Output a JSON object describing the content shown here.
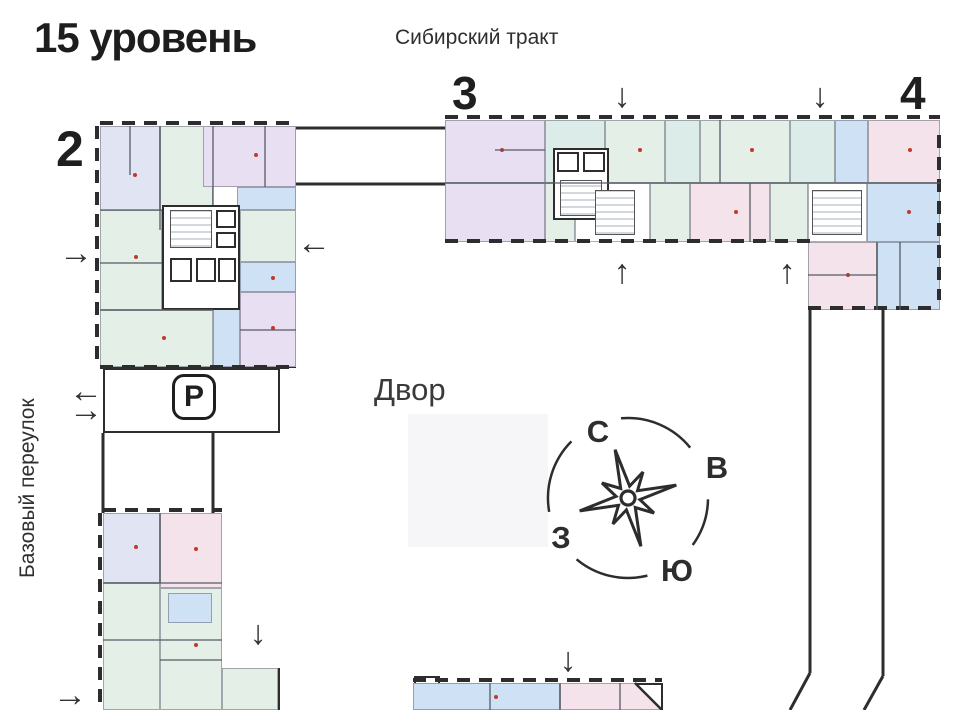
{
  "title": "15 уровень",
  "labels": {
    "street_top": "Сибирский тракт",
    "street_left": "Базовый переулок",
    "courtyard": "Двор",
    "parking": "P"
  },
  "buildings": [
    {
      "number": "2",
      "x": 56,
      "y": 124,
      "size": 50
    },
    {
      "number": "3",
      "x": 452,
      "y": 70,
      "size": 46
    },
    {
      "number": "4",
      "x": 900,
      "y": 70,
      "size": 46
    }
  ],
  "compass": {
    "north": "С",
    "east": "В",
    "south": "Ю",
    "west": "З",
    "letters": [
      {
        "key": "north",
        "x": 598,
        "y": 432
      },
      {
        "key": "east",
        "x": 717,
        "y": 468
      },
      {
        "key": "west",
        "x": 561,
        "y": 538
      },
      {
        "key": "south",
        "x": 677,
        "y": 571
      }
    ]
  },
  "colors": {
    "wall": "#2d2d2d",
    "lavender": "#e0e4f3",
    "green": "#e3efe7",
    "teal": "#dcece8",
    "purple": "#e9dff2",
    "pink": "#f5e3ec",
    "blue": "#cfe2f5",
    "courtyard_bg": "#f6f6f8",
    "marker_dot": "#c0392b"
  },
  "plan": {
    "courtyard_rect": {
      "x": 408,
      "y": 414,
      "w": 140,
      "h": 133
    },
    "outlines": [
      {
        "x": 100,
        "y": 126,
        "w": 196,
        "h": 242
      },
      {
        "x": 445,
        "y": 120,
        "w": 495,
        "h": 122
      },
      {
        "x": 808,
        "y": 242,
        "w": 132,
        "h": 68,
        "noTop": true
      },
      {
        "x": 103,
        "y": 513,
        "w": 119,
        "h": 200
      },
      {
        "x": 222,
        "y": 668,
        "w": 58,
        "h": 45
      },
      {
        "x": 413,
        "y": 683,
        "w": 250,
        "h": 30
      },
      {
        "x": 103,
        "y": 368,
        "w": 177,
        "h": 65
      },
      {
        "x": 414,
        "y": 676,
        "w": 26,
        "h": 10
      }
    ],
    "rects": [
      {
        "x": 100,
        "y": 126,
        "w": 60,
        "h": 104,
        "c": "lav",
        "dot": true
      },
      {
        "x": 160,
        "y": 126,
        "w": 53,
        "h": 87,
        "c": "green"
      },
      {
        "x": 203,
        "y": 126,
        "w": 93,
        "h": 61,
        "c": "purple",
        "dot": true
      },
      {
        "x": 237,
        "y": 187,
        "w": 59,
        "h": 23,
        "c": "blue"
      },
      {
        "x": 240,
        "y": 210,
        "w": 56,
        "h": 52,
        "c": "green"
      },
      {
        "x": 240,
        "y": 262,
        "w": 56,
        "h": 30,
        "c": "blue",
        "dot": true
      },
      {
        "x": 240,
        "y": 292,
        "w": 56,
        "h": 75,
        "c": "purple",
        "dot": true
      },
      {
        "x": 213,
        "y": 298,
        "w": 27,
        "h": 69,
        "c": "blue"
      },
      {
        "x": 100,
        "y": 310,
        "w": 113,
        "h": 57,
        "c": "green",
        "dot": true
      },
      {
        "x": 100,
        "y": 210,
        "w": 62,
        "h": 100,
        "c": "green",
        "dot": true
      },
      {
        "x": 445,
        "y": 120,
        "w": 100,
        "h": 63,
        "c": "purple",
        "dot": true
      },
      {
        "x": 545,
        "y": 120,
        "w": 60,
        "h": 63,
        "c": "teal"
      },
      {
        "x": 605,
        "y": 120,
        "w": 60,
        "h": 63,
        "c": "green",
        "dot": true
      },
      {
        "x": 665,
        "y": 120,
        "w": 35,
        "h": 63,
        "c": "teal"
      },
      {
        "x": 700,
        "y": 120,
        "w": 90,
        "h": 63,
        "c": "green",
        "dot": true
      },
      {
        "x": 790,
        "y": 120,
        "w": 45,
        "h": 63,
        "c": "teal"
      },
      {
        "x": 835,
        "y": 120,
        "w": 33,
        "h": 63,
        "c": "blue"
      },
      {
        "x": 868,
        "y": 120,
        "w": 72,
        "h": 63,
        "c": "pink",
        "dot": true
      },
      {
        "x": 445,
        "y": 183,
        "w": 100,
        "h": 59,
        "c": "purple"
      },
      {
        "x": 545,
        "y": 183,
        "w": 30,
        "h": 59,
        "c": "green"
      },
      {
        "x": 575,
        "y": 183,
        "w": 75,
        "h": 59,
        "c": "white"
      },
      {
        "x": 650,
        "y": 183,
        "w": 40,
        "h": 59,
        "c": "green"
      },
      {
        "x": 690,
        "y": 183,
        "w": 80,
        "h": 59,
        "c": "pink",
        "dot": true
      },
      {
        "x": 770,
        "y": 183,
        "w": 38,
        "h": 59,
        "c": "green"
      },
      {
        "x": 808,
        "y": 183,
        "w": 59,
        "h": 59,
        "c": "white"
      },
      {
        "x": 867,
        "y": 183,
        "w": 73,
        "h": 59,
        "c": "blue",
        "dot": true
      },
      {
        "x": 808,
        "y": 242,
        "w": 69,
        "h": 68,
        "c": "pink",
        "dot": true
      },
      {
        "x": 877,
        "y": 242,
        "w": 63,
        "h": 68,
        "c": "blue"
      },
      {
        "x": 103,
        "y": 513,
        "w": 57,
        "h": 70,
        "c": "lav",
        "dot": true
      },
      {
        "x": 160,
        "y": 513,
        "w": 62,
        "h": 75,
        "c": "pink",
        "dot": true
      },
      {
        "x": 103,
        "y": 583,
        "w": 57,
        "h": 127,
        "c": "green"
      },
      {
        "x": 160,
        "y": 588,
        "w": 62,
        "h": 122,
        "c": "green",
        "dot": true
      },
      {
        "x": 168,
        "y": 593,
        "w": 44,
        "h": 30,
        "c": "blue"
      },
      {
        "x": 222,
        "y": 668,
        "w": 56,
        "h": 42,
        "c": "green"
      },
      {
        "x": 413,
        "y": 683,
        "w": 147,
        "h": 27,
        "c": "blue",
        "dot": true
      },
      {
        "x": 560,
        "y": 683,
        "w": 102,
        "h": 27,
        "c": "pink",
        "clip": "polygon(0 0,73% 0,100% 100%,0 100%)"
      }
    ],
    "cores": [
      {
        "x": 162,
        "y": 205,
        "w": 78,
        "h": 105
      },
      {
        "x": 553,
        "y": 148,
        "w": 56,
        "h": 72
      }
    ],
    "hatches": [
      {
        "x": 170,
        "y": 210,
        "w": 42,
        "h": 38
      },
      {
        "x": 560,
        "y": 180,
        "w": 42,
        "h": 36
      },
      {
        "x": 595,
        "y": 190,
        "w": 40,
        "h": 45
      },
      {
        "x": 812,
        "y": 190,
        "w": 50,
        "h": 45
      }
    ],
    "shafts": [
      {
        "x": 216,
        "y": 210,
        "w": 20,
        "h": 18
      },
      {
        "x": 216,
        "y": 232,
        "w": 20,
        "h": 16
      },
      {
        "x": 170,
        "y": 258,
        "w": 22,
        "h": 24
      },
      {
        "x": 196,
        "y": 258,
        "w": 20,
        "h": 24
      },
      {
        "x": 218,
        "y": 258,
        "w": 18,
        "h": 24
      },
      {
        "x": 557,
        "y": 152,
        "w": 22,
        "h": 20
      },
      {
        "x": 583,
        "y": 152,
        "w": 22,
        "h": 20
      }
    ],
    "dashes": [
      {
        "x": 100,
        "y": 121,
        "len": 196,
        "o": "h"
      },
      {
        "x": 95,
        "y": 126,
        "len": 242,
        "o": "v"
      },
      {
        "x": 100,
        "y": 365,
        "len": 196,
        "o": "h"
      },
      {
        "x": 445,
        "y": 115,
        "len": 495,
        "o": "h"
      },
      {
        "x": 445,
        "y": 239,
        "len": 365,
        "o": "h"
      },
      {
        "x": 808,
        "y": 306,
        "len": 132,
        "o": "h"
      },
      {
        "x": 937,
        "y": 135,
        "len": 165,
        "o": "v"
      },
      {
        "x": 103,
        "y": 508,
        "len": 119,
        "o": "h"
      },
      {
        "x": 98,
        "y": 513,
        "len": 197,
        "o": "v"
      },
      {
        "x": 413,
        "y": 678,
        "len": 249,
        "o": "h"
      }
    ],
    "lines": [
      {
        "x1": 296,
        "y1": 128,
        "x2": 445,
        "y2": 128,
        "w": 3
      },
      {
        "x1": 296,
        "y1": 184,
        "x2": 445,
        "y2": 184,
        "w": 3
      },
      {
        "x1": 810,
        "y1": 310,
        "x2": 810,
        "y2": 673,
        "w": 3
      },
      {
        "x1": 810,
        "y1": 673,
        "x2": 790,
        "y2": 710,
        "w": 3
      },
      {
        "x1": 883,
        "y1": 310,
        "x2": 883,
        "y2": 676,
        "w": 3
      },
      {
        "x1": 883,
        "y1": 676,
        "x2": 864,
        "y2": 710,
        "w": 3
      },
      {
        "x1": 103,
        "y1": 433,
        "x2": 103,
        "y2": 513,
        "w": 3
      },
      {
        "x1": 213,
        "y1": 433,
        "x2": 213,
        "y2": 513,
        "w": 3
      },
      {
        "x1": 635,
        "y1": 683,
        "x2": 662,
        "y2": 710,
        "w": 2.5
      }
    ],
    "walls": [
      {
        "x1": 160,
        "y1": 126,
        "x2": 160,
        "y2": 230
      },
      {
        "x1": 213,
        "y1": 126,
        "x2": 213,
        "y2": 205
      },
      {
        "x1": 130,
        "y1": 126,
        "x2": 130,
        "y2": 175
      },
      {
        "x1": 265,
        "y1": 126,
        "x2": 265,
        "y2": 187
      },
      {
        "x1": 100,
        "y1": 263,
        "x2": 162,
        "y2": 263
      },
      {
        "x1": 240,
        "y1": 330,
        "x2": 296,
        "y2": 330
      },
      {
        "x1": 100,
        "y1": 210,
        "x2": 162,
        "y2": 210
      },
      {
        "x1": 100,
        "y1": 310,
        "x2": 213,
        "y2": 310
      },
      {
        "x1": 445,
        "y1": 183,
        "x2": 940,
        "y2": 183
      },
      {
        "x1": 495,
        "y1": 150,
        "x2": 545,
        "y2": 150
      },
      {
        "x1": 720,
        "y1": 120,
        "x2": 720,
        "y2": 183
      },
      {
        "x1": 750,
        "y1": 183,
        "x2": 750,
        "y2": 242
      },
      {
        "x1": 877,
        "y1": 242,
        "x2": 877,
        "y2": 310
      },
      {
        "x1": 808,
        "y1": 275,
        "x2": 877,
        "y2": 275
      },
      {
        "x1": 900,
        "y1": 242,
        "x2": 900,
        "y2": 310
      },
      {
        "x1": 160,
        "y1": 513,
        "x2": 160,
        "y2": 583
      },
      {
        "x1": 103,
        "y1": 583,
        "x2": 222,
        "y2": 583
      },
      {
        "x1": 103,
        "y1": 640,
        "x2": 222,
        "y2": 640
      },
      {
        "x1": 160,
        "y1": 660,
        "x2": 222,
        "y2": 660
      },
      {
        "x1": 490,
        "y1": 683,
        "x2": 490,
        "y2": 710
      },
      {
        "x1": 560,
        "y1": 683,
        "x2": 560,
        "y2": 710
      },
      {
        "x1": 620,
        "y1": 683,
        "x2": 620,
        "y2": 710
      }
    ],
    "arrows": [
      {
        "x": 622,
        "y": 96,
        "dir": "down"
      },
      {
        "x": 820,
        "y": 96,
        "dir": "down"
      },
      {
        "x": 622,
        "y": 272,
        "dir": "up"
      },
      {
        "x": 787,
        "y": 272,
        "dir": "up"
      },
      {
        "x": 76,
        "y": 253,
        "dir": "right"
      },
      {
        "x": 314,
        "y": 243,
        "dir": "left"
      },
      {
        "x": 86,
        "y": 391,
        "dir": "left"
      },
      {
        "x": 86,
        "y": 410,
        "dir": "right"
      },
      {
        "x": 70,
        "y": 695,
        "dir": "right"
      },
      {
        "x": 258,
        "y": 633,
        "dir": "down"
      },
      {
        "x": 568,
        "y": 660,
        "dir": "down"
      }
    ]
  }
}
